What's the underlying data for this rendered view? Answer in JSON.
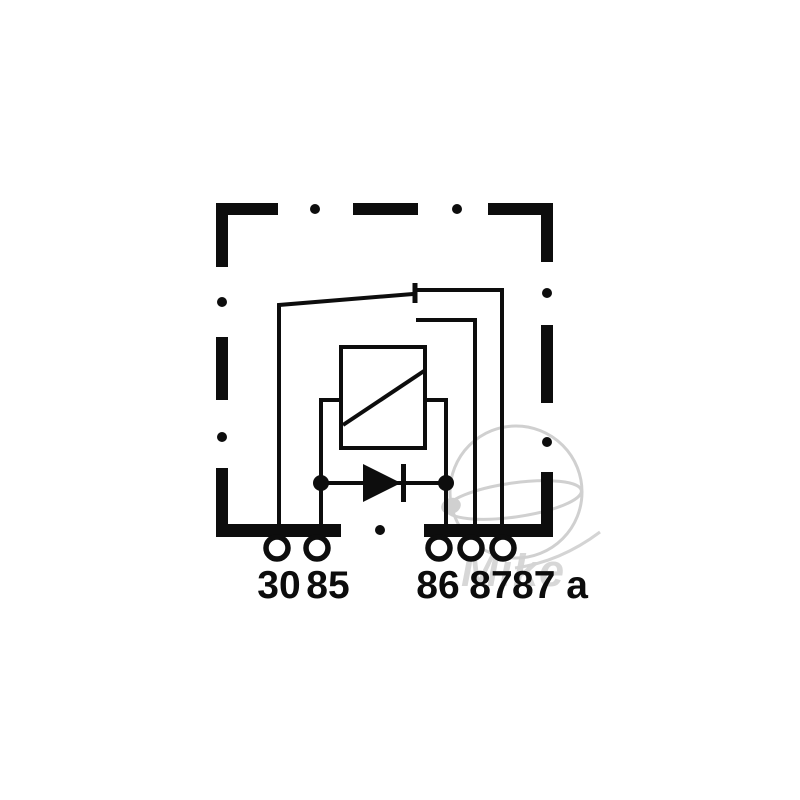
{
  "diagram": {
    "kind": "relay-wiring-schematic",
    "terminal_labels": [
      {
        "id": "30",
        "label": "30"
      },
      {
        "id": "85",
        "label": "85"
      },
      {
        "id": "86",
        "label": "86"
      },
      {
        "id": "87",
        "label": "87"
      },
      {
        "id": "87a",
        "label": "87 a"
      }
    ],
    "components": {
      "coil": "coil-with-diagonal-box",
      "diode": "diode-across-coil",
      "switch": "changeover-contact"
    }
  },
  "watermark": {
    "text": "Mike"
  },
  "colors": {
    "line": "#0d0d0d",
    "background": "#ffffff",
    "watermark_gray": "#d0d0d0"
  }
}
